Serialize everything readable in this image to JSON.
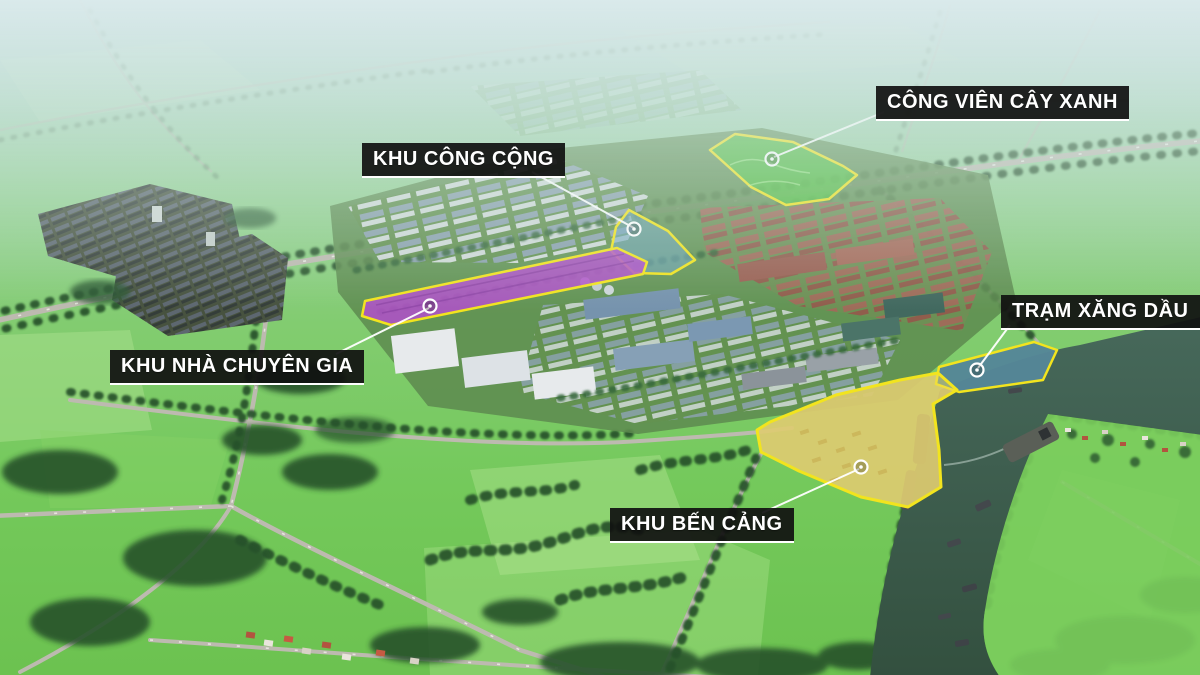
{
  "annotations": {
    "park": {
      "label": "CÔNG VIÊN CÂY XANH"
    },
    "public": {
      "label": "KHU CÔNG CỘNG"
    },
    "expert": {
      "label": "KHU NHÀ CHUYÊN GIA"
    },
    "gas": {
      "label": "TRẠM XĂNG DẦU"
    },
    "port": {
      "label": "KHU BẾN CẢNG"
    }
  },
  "zones": {
    "outline": "#F2E41E",
    "park": {
      "fill": "#49D335"
    },
    "public": {
      "fill": "#6FA7BD"
    },
    "expert": {
      "fill": "#B052C8"
    },
    "gas": {
      "fill": "#5E98AB"
    },
    "port": {
      "fill": "#EDD95E"
    }
  },
  "style": {
    "label_bg": "rgba(16,16,16,0.92)",
    "label_text": "#FFFFFF",
    "leader": "#FFFFFF",
    "river": "#3D6152",
    "road": "#BDBAB0",
    "field": "#79CB5D",
    "tree": "#27512C"
  }
}
